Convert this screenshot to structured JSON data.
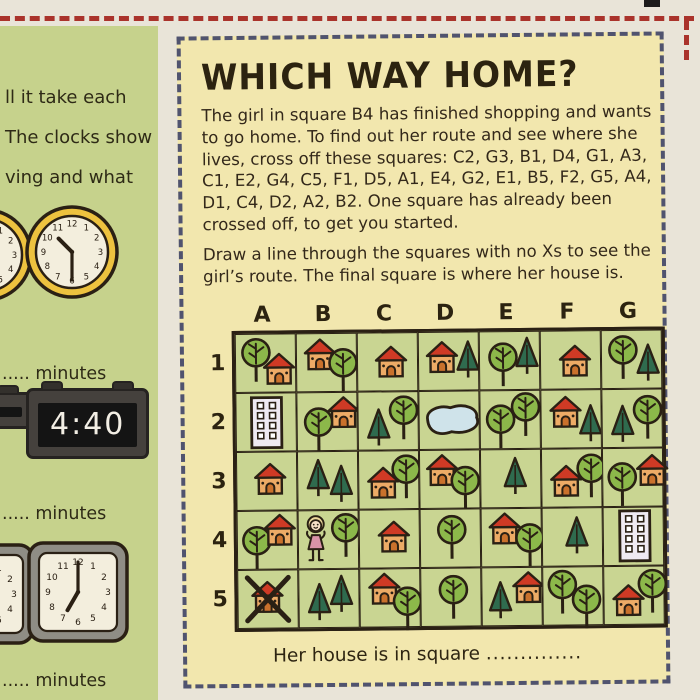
{
  "left": {
    "fragment_lines": [
      "ll it take each",
      "The clocks show",
      "ving and what"
    ],
    "minutes_label": "..... minutes"
  },
  "panel": {
    "title": "WHICH WAY HOME?",
    "para1": "The girl in square B4 has finished shopping and wants to go home. To find out her route and see where she lives, cross off these squares: C2, G3, B1, D4, G1, A3, C1, E2, G4, C5, F1, D5, A1, E4, G2, E1, B5, F2, G5, A4, D1, C4, D2, A2, B2. One square has already been crossed off, to get you started.",
    "para2": "Draw a line through the squares with no Xs to see the girl’s route. The final square is where her house is.",
    "caption_label": "Her house is in square",
    "caption_dots": ".............."
  },
  "grid": {
    "columns": [
      "A",
      "B",
      "C",
      "D",
      "E",
      "F",
      "G"
    ],
    "rows": [
      "1",
      "2",
      "3",
      "4",
      "5"
    ],
    "cells": {
      "A1": [
        {
          "icon": "round-tree",
          "x": 3,
          "y": 3
        },
        {
          "icon": "house",
          "x": 25,
          "y": 17
        }
      ],
      "B1": [
        {
          "icon": "house",
          "x": 5,
          "y": 3
        },
        {
          "icon": "round-tree",
          "x": 29,
          "y": 14
        }
      ],
      "C1": [
        {
          "icon": "house",
          "x": 15,
          "y": 11
        }
      ],
      "D1": [
        {
          "icon": "house",
          "x": 5,
          "y": 7
        },
        {
          "icon": "pine",
          "x": 36,
          "y": 7
        }
      ],
      "E1": [
        {
          "icon": "round-tree",
          "x": 6,
          "y": 10
        },
        {
          "icon": "pine",
          "x": 34,
          "y": 4
        }
      ],
      "F1": [
        {
          "icon": "house",
          "x": 16,
          "y": 12
        }
      ],
      "G1": [
        {
          "icon": "round-tree",
          "x": 4,
          "y": 4
        },
        {
          "icon": "pine",
          "x": 33,
          "y": 12
        }
      ],
      "A2": [
        {
          "icon": "building",
          "x": 13,
          "y": 2
        }
      ],
      "B2": [
        {
          "icon": "round-tree",
          "x": 4,
          "y": 14
        },
        {
          "icon": "house",
          "x": 28,
          "y": 2
        }
      ],
      "C2": [
        {
          "icon": "pine",
          "x": 7,
          "y": 15
        },
        {
          "icon": "round-tree",
          "x": 28,
          "y": 3
        }
      ],
      "D2": [
        {
          "icon": "pond",
          "x": 0,
          "y": 9
        }
      ],
      "E2": [
        {
          "icon": "round-tree",
          "x": 3,
          "y": 13
        },
        {
          "icon": "round-tree",
          "x": 28,
          "y": 1
        }
      ],
      "F2": [
        {
          "icon": "house",
          "x": 6,
          "y": 4
        },
        {
          "icon": "pine",
          "x": 36,
          "y": 13
        }
      ],
      "G2": [
        {
          "icon": "pine",
          "x": 7,
          "y": 14
        },
        {
          "icon": "round-tree",
          "x": 28,
          "y": 5
        }
      ],
      "A3": [
        {
          "icon": "house",
          "x": 15,
          "y": 9
        }
      ],
      "B3": [
        {
          "icon": "pine",
          "x": 7,
          "y": 6
        },
        {
          "icon": "pine",
          "x": 30,
          "y": 12
        }
      ],
      "C3": [
        {
          "icon": "house",
          "x": 6,
          "y": 14
        },
        {
          "icon": "round-tree",
          "x": 30,
          "y": 3
        }
      ],
      "D3": [
        {
          "icon": "house",
          "x": 4,
          "y": 2
        },
        {
          "icon": "round-tree",
          "x": 28,
          "y": 15
        }
      ],
      "E3": [
        {
          "icon": "pine",
          "x": 21,
          "y": 6
        }
      ],
      "F3": [
        {
          "icon": "house",
          "x": 6,
          "y": 14
        },
        {
          "icon": "round-tree",
          "x": 32,
          "y": 4
        }
      ],
      "G3": [
        {
          "icon": "round-tree",
          "x": 2,
          "y": 13
        },
        {
          "icon": "house",
          "x": 31,
          "y": 4
        }
      ],
      "A4": [
        {
          "icon": "round-tree",
          "x": 2,
          "y": 14
        },
        {
          "icon": "house",
          "x": 24,
          "y": 1
        }
      ],
      "B4": [
        {
          "icon": "girl",
          "x": 4,
          "y": 4
        },
        {
          "icon": "round-tree",
          "x": 30,
          "y": 2
        }
      ],
      "C4": [
        {
          "icon": "house",
          "x": 16,
          "y": 9
        }
      ],
      "D4": [
        {
          "icon": "round-tree",
          "x": 14,
          "y": 5
        }
      ],
      "E4": [
        {
          "icon": "house",
          "x": 5,
          "y": 2
        },
        {
          "icon": "round-tree",
          "x": 31,
          "y": 14
        }
      ],
      "F4": [
        {
          "icon": "pine",
          "x": 21,
          "y": 7
        }
      ],
      "G4": [
        {
          "icon": "building",
          "x": 14,
          "y": 1
        }
      ],
      "A5": [
        {
          "icon": "house",
          "x": 11,
          "y": 9
        },
        {
          "icon": "cross",
          "x": 0,
          "y": 0
        }
      ],
      "B5": [
        {
          "icon": "pine",
          "x": 7,
          "y": 12
        },
        {
          "icon": "pine",
          "x": 29,
          "y": 4
        }
      ],
      "C5": [
        {
          "icon": "house",
          "x": 6,
          "y": 2
        },
        {
          "icon": "round-tree",
          "x": 30,
          "y": 17
        }
      ],
      "D5": [
        {
          "icon": "round-tree",
          "x": 15,
          "y": 6
        }
      ],
      "E5": [
        {
          "icon": "pine",
          "x": 5,
          "y": 12
        },
        {
          "icon": "house",
          "x": 28,
          "y": 2
        }
      ],
      "F5": [
        {
          "icon": "round-tree",
          "x": 2,
          "y": 2
        },
        {
          "icon": "round-tree",
          "x": 26,
          "y": 17
        }
      ],
      "G5": [
        {
          "icon": "house",
          "x": 6,
          "y": 16
        },
        {
          "icon": "round-tree",
          "x": 31,
          "y": 2
        }
      ]
    }
  },
  "clocks": {
    "numerals": [
      "12",
      "1",
      "2",
      "3",
      "4",
      "5",
      "6",
      "7",
      "8",
      "9",
      "10",
      "11"
    ],
    "round_partial": {
      "time": "9:45"
    },
    "round_main": {
      "time": "10:30"
    },
    "digital_main": {
      "time": "4:40"
    },
    "square_partial": {
      "time": "9:45"
    },
    "square_main": {
      "time": "7:00"
    }
  },
  "colors": {
    "paper": "#e9e4d8",
    "left_page": "#c6d28c",
    "panel_bg": "#f2e7ae",
    "panel_dash": "#50536f",
    "red_dash": "#aa332b",
    "ink": "#2a2014",
    "cell_bg": "#c9d592",
    "tree_green": "#8cb84a",
    "pine_green": "#2f6b4e",
    "roof_red": "#cf3a25",
    "house_body": "#edab66",
    "door": "#c9712c",
    "building": "#efeaf2",
    "pond": "#cfe3ea",
    "girl_dress": "#d993a8",
    "girl_hair": "#edd79b",
    "girl_skin": "#f6e0c6",
    "clock_ring_yellow": "#edc23f",
    "clock_face": "#f3eedd",
    "clock_frame_gray": "#8f8d85"
  }
}
